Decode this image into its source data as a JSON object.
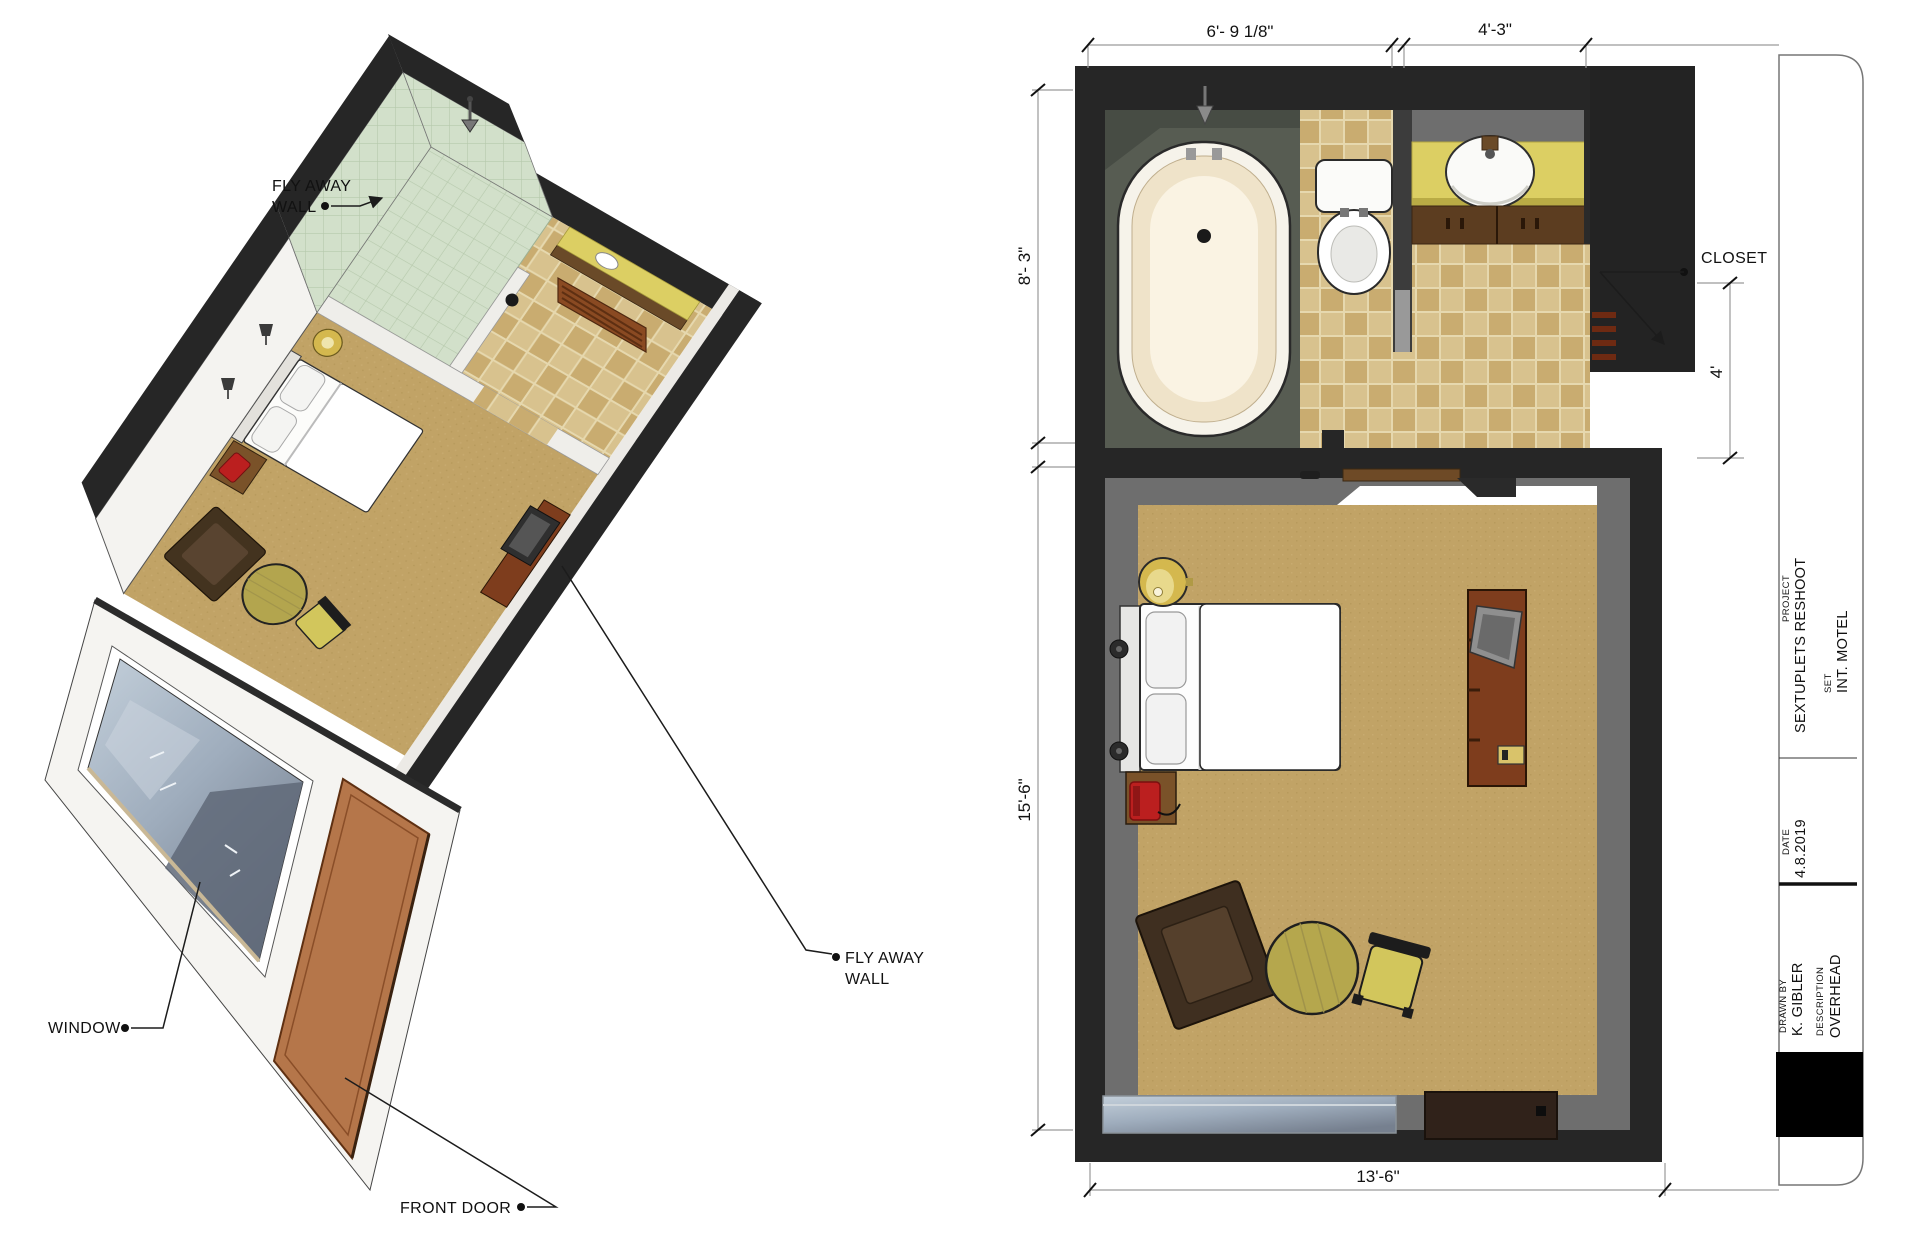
{
  "document": {
    "kind": "set design drawing, isometric cutaway + overhead plan",
    "background": "#ffffff"
  },
  "isometric_view": {
    "labels": {
      "fly_away_wall_top_line1": "FLY AWAY",
      "fly_away_wall_top_line2": "WALL",
      "window": "WINDOW",
      "front_door": "FRONT DOOR",
      "fly_away_wall_right_line1": "FLY AWAY",
      "fly_away_wall_right_line2": "WALL"
    }
  },
  "overhead_plan": {
    "labels": {
      "closet": "CLOSET"
    },
    "dimensions": {
      "bath_width": "6'- 9 1/8\"",
      "vanity_width": "4'-3\"",
      "bath_depth": "8'- 3\"",
      "bedroom_depth": "15'-6\"",
      "bedroom_width": "13'-6\"",
      "closet_depth": "4'"
    }
  },
  "title_block": {
    "project_label": "PROJECT",
    "project": "SEXTUPLETS RESHOOT",
    "set_label": "SET",
    "set": "INT. MOTEL",
    "date_label": "DATE",
    "date": "4.8.2019",
    "drawn_by_label": "DRAWN BY",
    "drawn_by": "K. GIBLER",
    "description_label": "DESCRIPTION",
    "description": "OVERHEAD"
  },
  "palette": {
    "wall_dark": "#262626",
    "wall_gray": "#6e6e6e",
    "carpet": "#c1a366",
    "tile_light": "#d8c28e",
    "tile_dark": "#cbaf74",
    "shower_green": "#cfdfc9",
    "counter_yellow": "#dccf63",
    "cabinet_wood": "#5c3d20",
    "dresser_wood": "#7e3d1d",
    "phone_red": "#bb1f1f",
    "window_glass": "#b6c2cc",
    "door_brown": "#b5764a",
    "lamp_gold": "#d4b84e"
  }
}
